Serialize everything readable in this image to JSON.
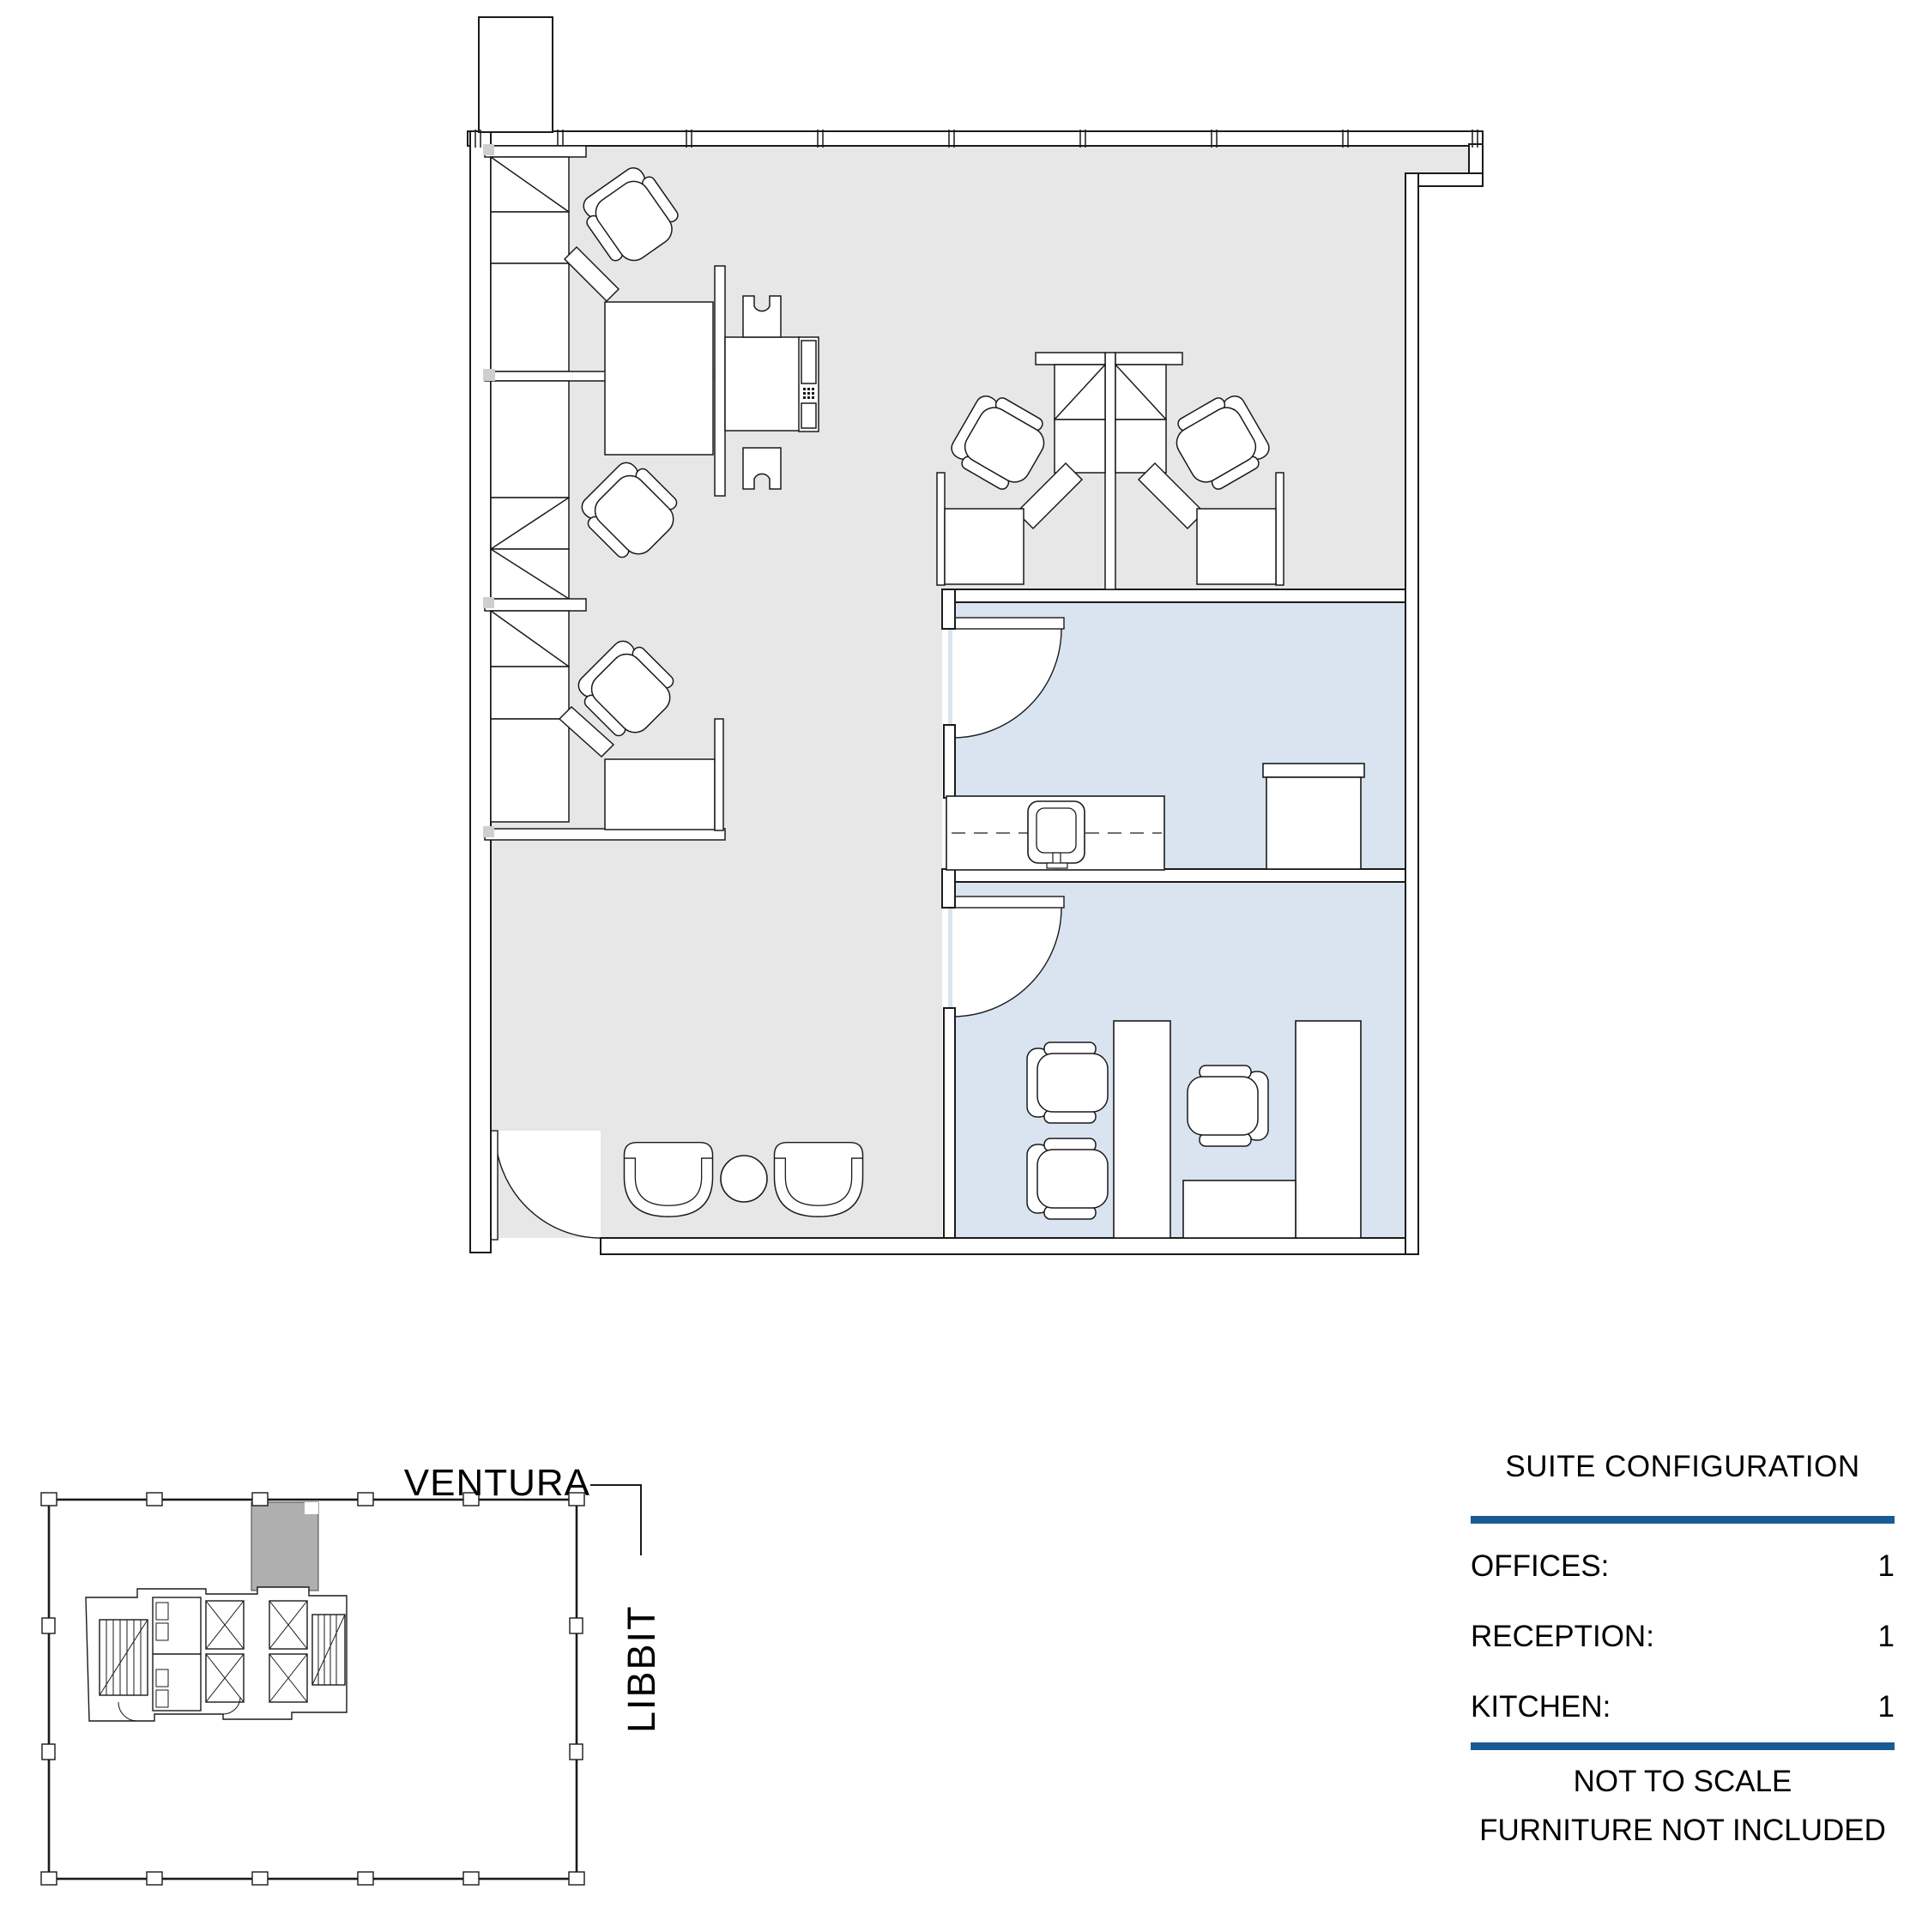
{
  "colors": {
    "accent_blue": "#1A5B96",
    "floor_gray": "#E7E7E7",
    "room_blue": "#D9E4F0",
    "suite_highlight_gray": "#AFAFAF",
    "line_black": "#1A1A1A"
  },
  "key_plan": {
    "street_top": "VENTURA",
    "street_right": "LIBBIT"
  },
  "config_panel": {
    "title": "SUITE CONFIGURATION",
    "rows": [
      {
        "label": "OFFICES:",
        "value": "1"
      },
      {
        "label": "RECEPTION:",
        "value": "1"
      },
      {
        "label": "KITCHEN:",
        "value": "1"
      }
    ],
    "notes": [
      "NOT TO SCALE",
      "FURNITURE NOT INCLUDED"
    ]
  }
}
